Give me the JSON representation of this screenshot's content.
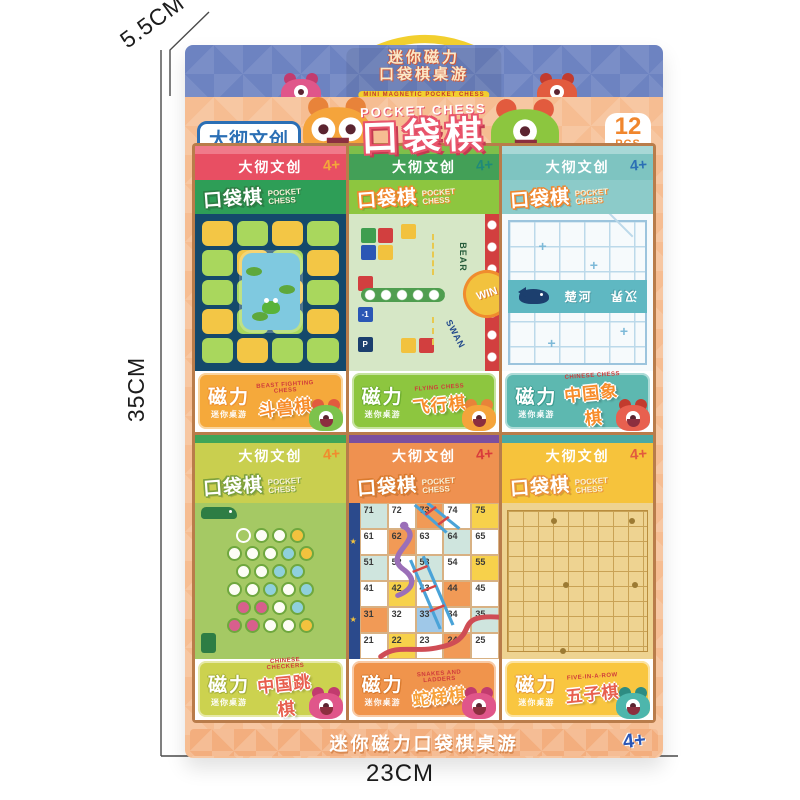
{
  "dimensions": {
    "depth": "5.5CM",
    "height": "35CM",
    "width": "23CM"
  },
  "box": {
    "top_band": {
      "line1": "迷你磁力",
      "line2": "口袋棋桌游",
      "subtitle": "MINI MAGNETIC POCKET CHESS"
    },
    "header": {
      "brand": "大彻文创",
      "title_en": "POCKET CHESS",
      "title_cn": "口袋棋",
      "count": "12",
      "unit": "PCS"
    },
    "footer": {
      "text": "迷你磁力口袋棋桌游",
      "age": "4+"
    },
    "cards": [
      {
        "brand": "大彻文创",
        "age": "4+",
        "pocket_cn": "口袋棋",
        "pocket_en1": "POCKET",
        "pocket_en2": "CHESS",
        "magnet": "磁力",
        "mini": "迷你桌游",
        "name_cn": "斗兽棋",
        "name_en": "BEAST FIGHTING CHESS"
      },
      {
        "brand": "大彻文创",
        "age": "4+",
        "pocket_cn": "口袋棋",
        "pocket_en1": "POCKET",
        "pocket_en2": "CHESS",
        "magnet": "磁力",
        "mini": "迷你桌游",
        "name_cn": "飞行棋",
        "name_en": "FLYING CHESS"
      },
      {
        "brand": "大彻文创",
        "age": "4+",
        "pocket_cn": "口袋棋",
        "pocket_en1": "POCKET",
        "pocket_en2": "CHESS",
        "magnet": "磁力",
        "mini": "迷你桌游",
        "name_cn": "中国象棋",
        "name_en": "CHINESE CHESS"
      },
      {
        "brand": "大彻文创",
        "age": "4+",
        "pocket_cn": "口袋棋",
        "pocket_en1": "POCKET",
        "pocket_en2": "CHESS",
        "magnet": "磁力",
        "mini": "迷你桌游",
        "name_cn": "中国跳棋",
        "name_en": "CHINESE CHECKERS"
      },
      {
        "brand": "大彻文创",
        "age": "4+",
        "pocket_cn": "口袋棋",
        "pocket_en1": "POCKET",
        "pocket_en2": "CHESS",
        "magnet": "磁力",
        "mini": "迷你桌游",
        "name_cn": "蛇梯棋",
        "name_en": "SNAKES AND LADDERS"
      },
      {
        "brand": "大彻文创",
        "age": "4+",
        "pocket_cn": "口袋棋",
        "pocket_en1": "POCKET",
        "pocket_en2": "CHESS",
        "magnet": "磁力",
        "mini": "迷你桌游",
        "name_cn": "五子棋",
        "name_en": "FIVE-IN-A-ROW"
      }
    ],
    "boards": {
      "flying": {
        "win": "WIN",
        "bear": "BEAR",
        "swan": "SWAN",
        "minus_one": "-1",
        "parking": "P"
      },
      "xiangqi": {
        "river_left": "楚河",
        "river_right": "汉界"
      },
      "snakes": {
        "rows": [
          [
            71,
            72,
            73,
            74,
            75
          ],
          [
            61,
            62,
            63,
            64,
            65
          ],
          [
            51,
            52,
            53,
            54,
            55
          ],
          [
            41,
            42,
            43,
            44,
            45
          ],
          [
            31,
            32,
            33,
            34,
            35
          ],
          [
            21,
            22,
            23,
            24,
            25
          ]
        ]
      }
    },
    "colors": {
      "box_face": "#f6bd92",
      "top_band": "#6d83c1",
      "brand_blue": "#2b6fb5",
      "title_outline": "#e8546b",
      "pcs_orange": "#f0862d",
      "footer_age_blue": "#2b57b5",
      "card_headers": [
        "#e84f63",
        "#43a057",
        "#7ec4c1",
        "#c9cf4f",
        "#ef9150",
        "#f6c33c"
      ],
      "label_bgs": [
        "#f5a93b",
        "#8dc63f",
        "#5db8b0",
        "#ccd24f",
        "#f0944c",
        "#f9c640"
      ]
    }
  }
}
